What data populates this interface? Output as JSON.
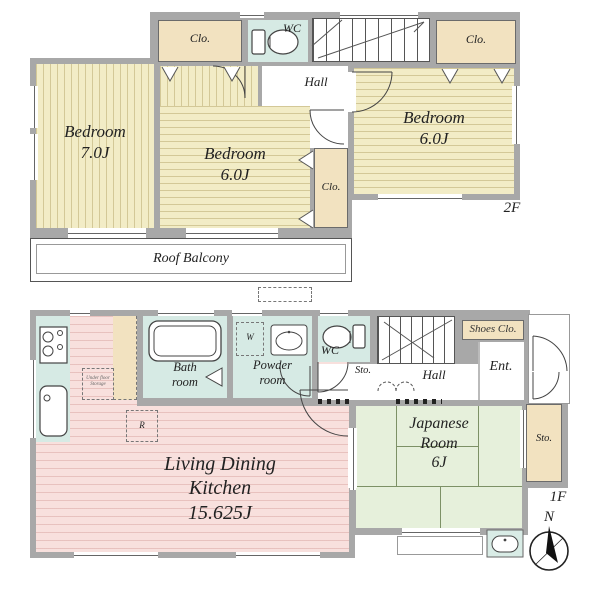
{
  "floor2": {
    "floor_label": "2F",
    "bedroom7": "Bedroom\n7.0J",
    "bedroom6_center": "Bedroom\n6.0J",
    "bedroom6_right": "Bedroom\n6.0J",
    "closet_top_left": "Clo.",
    "closet_top_right": "Clo.",
    "closet_center": "Clo.",
    "wc": "WC",
    "hall": "Hall",
    "roof_balcony": "Roof Balcony"
  },
  "floor1": {
    "floor_label": "1F",
    "ldk": "Living Dining\nKitchen\n15.625J",
    "bath": "Bath\nroom",
    "powder": "Powder\nroom",
    "wc": "WC",
    "washer": "W",
    "hall": "Hall",
    "storage_hall": "Sto.",
    "shoes_closet": "Shoes Clo.",
    "entrance": "Ent.",
    "japanese_room": "Japanese\nRoom\n6J",
    "storage_right": "Sto.",
    "refrigerator": "R",
    "underfloor": "Under floor\nStorage"
  },
  "compass": {
    "north": "N"
  },
  "colors": {
    "wall": "#A8A8A8",
    "bedroom": "#F2ECC6",
    "closet": "#F2E2C0",
    "wet": "#D6EAE4",
    "ldk": "#F8E0DD",
    "tatami": "#E6F0DB"
  }
}
